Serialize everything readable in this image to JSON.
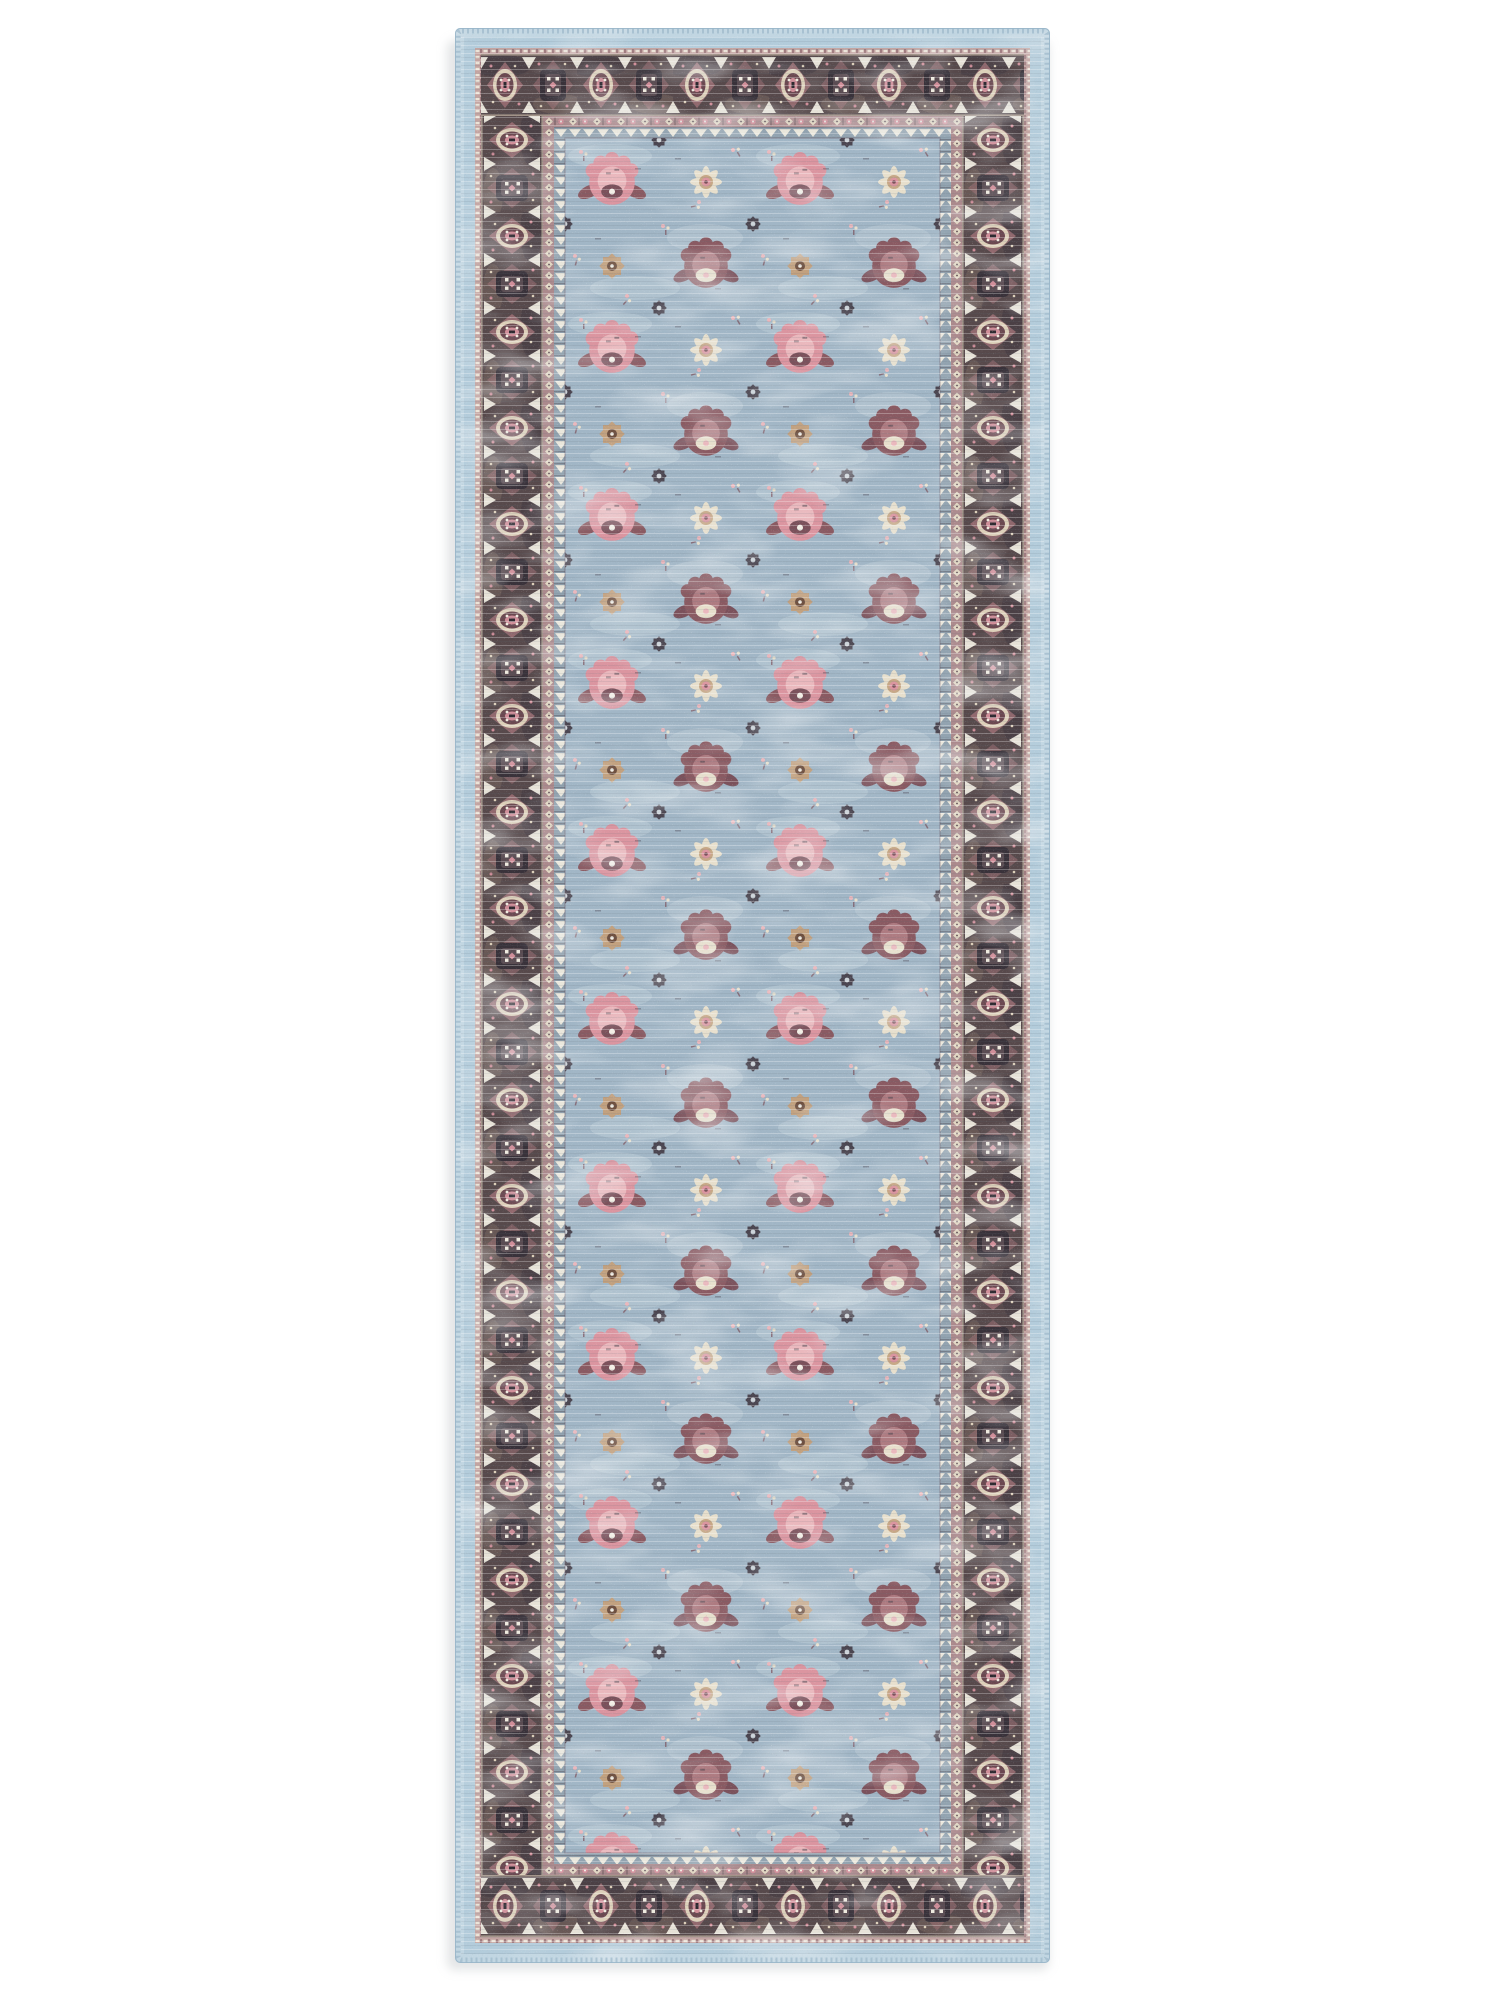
{
  "scene": {
    "subject": "vintage distressed runner rug product photo",
    "background": "#ffffff",
    "shadow": "#c7cbcd"
  },
  "rug": {
    "edge": {
      "serged": "#c1d6e2",
      "stitch": "#9cb8cb",
      "hairline": "#93b2c5",
      "inner_band": "#b3ccdb"
    },
    "outer_guard": {
      "background": "#c3a4a1",
      "dash": "#ece4d8",
      "tick": "#7b515b"
    },
    "border": {
      "background": "#57494b",
      "mottle_dark": "#413840",
      "mottle_light": "#7d6a62",
      "edge_line": "#ddd0ba",
      "diamond": "#9c6e74",
      "oval_ring": "#ddd0ba",
      "oval_fill": "#6b4850",
      "oval_core": "#d08e99",
      "cartouche": "#39323a",
      "cartouche_inner": "#5a4c52",
      "white": "#efeadf",
      "dot_pink": "#d08e99",
      "dot_cream": "#ddd0ba",
      "center_dark": "#2e2930"
    },
    "chain_guard": {
      "background": "#ab898c",
      "diamond": "#e2d7c3",
      "dot": "#d18f9a",
      "tick": "#5d4c52",
      "eye": "#f6f2e9"
    },
    "zigzag_guard": {
      "background": "#92a3b0",
      "triangle": "#eae7dc",
      "line": "#3f3a42"
    },
    "field": {
      "background": "#a1b6c6",
      "patch": "#c2d1d9",
      "pink": "#db95a0",
      "pink_light": "#eab8bd",
      "plum": "#7b515b",
      "mauve": "#8a5a62",
      "mauve_light": "#ae7b81",
      "cream": "#e7dfcc",
      "tan": "#c2a17f",
      "brown": "#6e5040",
      "charcoal": "#433c46",
      "star_eye": "#cfd6da",
      "white": "#f3efe6",
      "boundary_line": "#6b5560"
    },
    "weave": {
      "light": "#ffffff",
      "dark": "#5a6a74"
    }
  }
}
